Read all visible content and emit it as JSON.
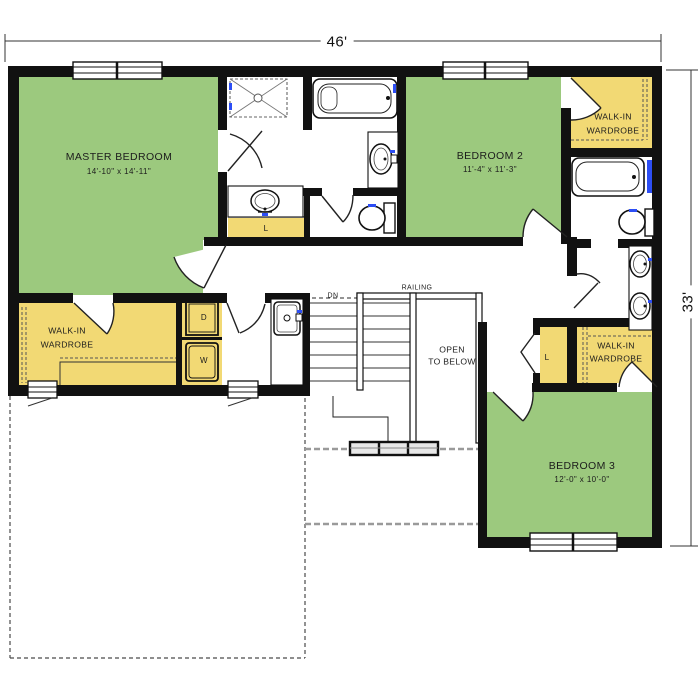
{
  "dimensions": {
    "width_label": "46'",
    "height_label": "33'"
  },
  "rooms": {
    "master_bedroom": {
      "name": "MASTER BEDROOM",
      "size": "14'-10\" x 14'-11\""
    },
    "bedroom_2": {
      "name": "BEDROOM 2",
      "size": "11'-4\" x 11'-3\""
    },
    "bedroom_3": {
      "name": "BEDROOM 3",
      "size": "12'-0\" x 10'-0\""
    },
    "master_wardrobe": {
      "line1": "WALK-IN",
      "line2": "WARDROBE"
    },
    "wardrobe_2": {
      "line1": "WALK-IN",
      "line2": "WARDROBE"
    },
    "wardrobe_3": {
      "line1": "WALK-IN",
      "line2": "WARDROBE"
    },
    "linen_hall": {
      "label": "L"
    },
    "linen_bedroom3": {
      "label": "L"
    },
    "dryer": {
      "label": "D"
    },
    "washer": {
      "label": "W"
    }
  },
  "stairs": {
    "down_label": "DN",
    "railing_label": "RAILING",
    "open_line1": "OPEN",
    "open_line2": "TO BELOW"
  },
  "colors": {
    "bedroom_green": "#9cc97e",
    "closet_yellow": "#f2d974",
    "wall_black": "#111111",
    "fixture_blue": "#2d4ef5",
    "dashed_gray": "#555555"
  }
}
